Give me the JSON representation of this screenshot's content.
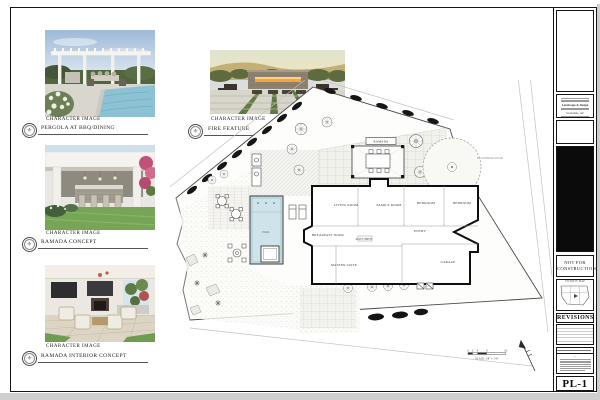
{
  "brand": {
    "name": "AXIOM",
    "tagline": "Landscape & Design",
    "fleur_icon": "⚜",
    "info_line_bold": "Landscape & Design",
    "info_line_city": "Scottsdale, AZ"
  },
  "callouts": [
    {
      "caption": "CHARACTER IMAGE",
      "label": "PERGOLA AT BBQ/DINING"
    },
    {
      "caption": "CHARACTER IMAGE",
      "label": "RAMADA CONCEPT"
    },
    {
      "caption": "CHARACTER IMAGE",
      "label": "RAMADA INTERIOR CONCEPT"
    },
    {
      "caption": "CHARACTER IMAGE",
      "label": "FIRE FEATURE"
    }
  ],
  "titleblock": {
    "not_for_construction": "NOT FOR\nCONSTRUCTION",
    "vicinity_map": "VICINITY MAP",
    "revisions": "REVISIONS",
    "sheet_number": "PL-1"
  },
  "plan": {
    "rooms": [
      "LIVING ROOM",
      "FAMILY ROOM",
      "BEDROOM",
      "BEDROOM",
      "ENTRY",
      "BREAKFAST NOOK",
      "KITCHEN",
      "MASTER SUITE",
      "GARAGE"
    ],
    "labels": {
      "ramada": "RAMADA",
      "pool": "POOL",
      "flowering_pear": "FLOWERING PEAR"
    },
    "scale_text": "SCALE: 1/8\" = 1'-0\"",
    "scale_ticks": [
      "0",
      "2",
      "4",
      "8",
      "16"
    ]
  }
}
